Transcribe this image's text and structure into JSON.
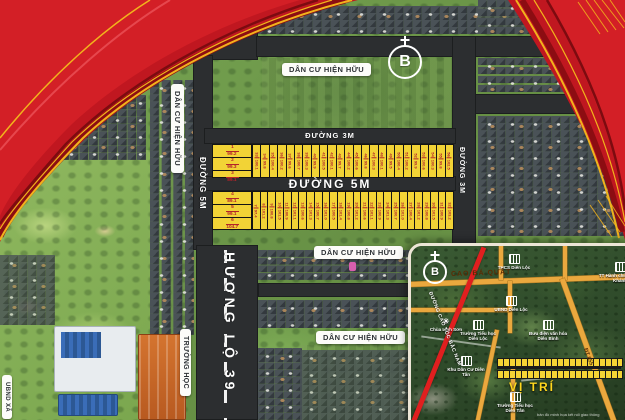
{
  "colors": {
    "plot_yellow": "#f2d336",
    "plot_text_red": "#b3242a",
    "road_dark": "#2c2e30",
    "ribbon_red": "#c01720",
    "ribbon_stripe_yellow": "#f2b31c",
    "inset_road_orange": "#eaa83e",
    "expressway_red": "#e01f1f",
    "location_yellow": "#ffd71e"
  },
  "map_labels": {
    "existing_residential_top": "DÂN CƯ HIỆN HỮU",
    "existing_residential_left": "DÂN CƯ HIỆN HỮU",
    "existing_residential_mid": "DÂN CƯ HIỆN HỮU",
    "existing_residential_bottom": "DÂN CƯ HIỆN HỮU",
    "highway": "HƯƠNG LỘ 39",
    "road_5m_vertical": "ĐƯỜNG 5M",
    "road_3m_top": "ĐƯỜNG 3M",
    "road_5m_main": "ĐƯỜNG 5M",
    "road_3m_right": "ĐƯỜNG 3M",
    "school": "TRƯỜNG HỌC",
    "commune_office": "UBND XÃ",
    "compass_letter": "B"
  },
  "plots": {
    "block_a": [
      {
        "no": "1",
        "area": "99.2"
      },
      {
        "no": "2",
        "area": "99.3"
      },
      {
        "no": "3",
        "area": "89.1"
      }
    ],
    "block_b": [
      {
        "no": "4",
        "area": "89.1"
      },
      {
        "no": "5",
        "area": "99.1"
      },
      {
        "no": "6",
        "area": "104.7"
      }
    ],
    "row_top": [
      {
        "no": "33",
        "area": "100.1"
      },
      {
        "no": "34",
        "area": "99.8"
      },
      {
        "no": "35",
        "area": "100.4"
      },
      {
        "no": "36",
        "area": "100.2"
      },
      {
        "no": "37",
        "area": "99.6"
      },
      {
        "no": "38",
        "area": "100.7"
      },
      {
        "no": "39",
        "area": "100.3"
      },
      {
        "no": "40",
        "area": "99.9"
      },
      {
        "no": "41",
        "area": "100.5"
      },
      {
        "no": "42",
        "area": "100.1"
      },
      {
        "no": "43",
        "area": "99.7"
      },
      {
        "no": "44",
        "area": "100.2"
      },
      {
        "no": "45",
        "area": "100.6"
      },
      {
        "no": "46",
        "area": "99.8"
      },
      {
        "no": "47",
        "area": "100.3"
      },
      {
        "no": "48",
        "area": "100.1"
      },
      {
        "no": "49",
        "area": "99.5"
      },
      {
        "no": "50",
        "area": "100.4"
      },
      {
        "no": "51",
        "area": "100.2"
      },
      {
        "no": "52",
        "area": "99.9"
      },
      {
        "no": "53",
        "area": "100.6"
      },
      {
        "no": "54",
        "area": "100.3"
      },
      {
        "no": "55",
        "area": "99.8"
      },
      {
        "no": "56",
        "area": "102.5"
      }
    ],
    "row_bottom": [
      {
        "no": "7",
        "area": "97.4"
      },
      {
        "no": "8",
        "area": "101.2"
      },
      {
        "no": "9",
        "area": "100.8"
      },
      {
        "no": "10",
        "area": "101.5"
      },
      {
        "no": "11",
        "area": "100.9"
      },
      {
        "no": "12",
        "area": "101.1"
      },
      {
        "no": "13",
        "area": "100.6"
      },
      {
        "no": "14",
        "area": "101.3"
      },
      {
        "no": "15",
        "area": "100.7"
      },
      {
        "no": "16",
        "area": "101.0"
      },
      {
        "no": "17",
        "area": "100.5"
      },
      {
        "no": "18",
        "area": "101.4"
      },
      {
        "no": "19",
        "area": "100.8"
      },
      {
        "no": "20",
        "area": "101.2"
      },
      {
        "no": "21",
        "area": "100.6"
      },
      {
        "no": "22",
        "area": "101.1"
      },
      {
        "no": "23",
        "area": "100.9"
      },
      {
        "no": "24",
        "area": "101.3"
      },
      {
        "no": "25",
        "area": "100.7"
      },
      {
        "no": "26",
        "area": "101.0"
      },
      {
        "no": "27",
        "area": "100.4"
      },
      {
        "no": "28",
        "area": "101.2"
      },
      {
        "no": "29",
        "area": "100.8"
      },
      {
        "no": "30",
        "area": "101.5"
      },
      {
        "no": "31",
        "area": "100.9"
      },
      {
        "no": "32",
        "area": "103.2"
      }
    ]
  },
  "inset": {
    "compass_letter": "B",
    "road_cao_ba_quat": "CAO BÁ QUÁT",
    "expressway_label": "ĐƯỜNG CAO TỐC BẮC NAM",
    "road_dt655": "ĐT 655",
    "location_label": "VỊ TRÍ",
    "watermark": "bản đồ minh họa kết nối giao thông",
    "pois": [
      {
        "name": "THCS Diên Lộc"
      },
      {
        "name": "TT Hành chính Diên Khánh"
      },
      {
        "name": "UBND Diên Lộc"
      },
      {
        "name": "Trường Tiểu học Diên Lộc"
      },
      {
        "name": "Bưu điện văn hóa Diên Bình"
      },
      {
        "name": "Chùa Linh Sơn"
      },
      {
        "name": "Khu Dân Cư Diên Tân"
      },
      {
        "name": "Trường Tiểu học Diên Tân"
      }
    ]
  }
}
